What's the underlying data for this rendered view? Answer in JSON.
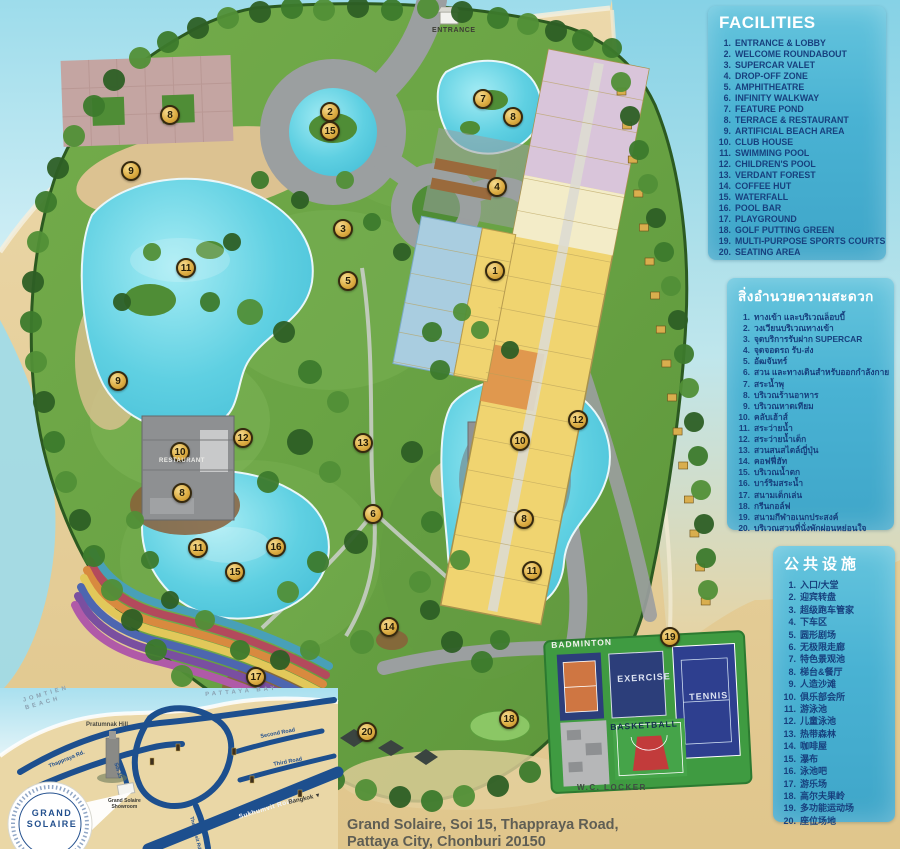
{
  "page": {
    "address_line1": "Grand Solaire, Soi 15, Thappraya Road,",
    "address_line2": "Pattaya City, Chonburi 20150"
  },
  "legend_en": {
    "title": "FACILITIES",
    "items": [
      "ENTRANCE & LOBBY",
      "WELCOME ROUNDABOUT",
      "SUPERCAR VALET",
      "DROP-OFF ZONE",
      "AMPHITHEATRE",
      "INFINITY WALKWAY",
      "FEATURE POND",
      "TERRACE & RESTAURANT",
      "ARTIFICIAL BEACH AREA",
      "CLUB HOUSE",
      "SWIMMING POOL",
      "CHILDREN'S POOL",
      "VERDANT FOREST",
      "COFFEE HUT",
      "WATERFALL",
      "POOL BAR",
      "PLAYGROUND",
      "GOLF PUTTING GREEN",
      "MULTI-PURPOSE SPORTS COURTS",
      "SEATING AREA"
    ]
  },
  "legend_th": {
    "title": "สิ่งอำนวยความสะดวก",
    "items": [
      "ทางเข้า และบริเวณล็อบบี้",
      "วงเวียนบริเวณทางเข้า",
      "จุดบริการรับฝาก SUPERCAR",
      "จุดจอดรถ รับ-ส่ง",
      "อัฒจันทร์",
      "สวน และทางเดินสำหรับออกกำลังกาย",
      "สระน้ำพุ",
      "บริเวณร้านอาหาร",
      "บริเวณหาดเทียม",
      "คลับเฮ้าส์",
      "สระว่ายน้ำ",
      "สระว่ายน้ำเด็ก",
      "สวนสนสไตล์ญี่ปุ่น",
      "คอฟฟี่ฮัท",
      "บริเวณน้ำตก",
      "บาร์ริมสระน้ำ",
      "สนามเด็กเล่น",
      "กรีนกอล์ฟ",
      "สนามกีฬาอเนกประสงค์",
      "บริเวณสวนที่นั่งพักผ่อนหย่อนใจ"
    ]
  },
  "legend_zh": {
    "title": "公共设施",
    "items": [
      "入口/大堂",
      "迎宾转盘",
      "超级跑车管家",
      "下车区",
      "圆形剧场",
      "无极限走廊",
      "特色景观池",
      "梯台&餐厅",
      "人造沙滩",
      "俱乐部会所",
      "游泳池",
      "儿童泳池",
      "热带森林",
      "咖啡屋",
      "瀑布",
      "泳池吧",
      "游乐场",
      "高尔夫果岭",
      "多功能运动场",
      "座位场地"
    ]
  },
  "map_labels": {
    "entrance": "ENTRANCE",
    "restaurant": "RESTAURANT",
    "badminton": "BADMINTON",
    "exercise": "EXERCISE",
    "tennis": "TENNIS",
    "basketball": "BASKETBALL",
    "locker": "W.C. LOCKER"
  },
  "inset": {
    "jomtien_line1": "JOMTIEN",
    "jomtien_line2": "BEACH",
    "pattaya_bay": "PATTAYA BAY",
    "pratumnak": "Pratumnak Hill",
    "thappraya": "Thappraya Rd.",
    "soi15": "Soi 15",
    "second_road": "Second Road",
    "third_road": "Third Road",
    "thepprasit": "Thepprasit Rd.",
    "sukhumvit": "Sukhumvit Road",
    "bangkok": "Bangkok ▼",
    "showroom_line1": "Grand Solaire",
    "showroom_line2": "Showroom",
    "logo_line1": "GRAND",
    "logo_line2": "SOLAIRE"
  },
  "markers": [
    {
      "n": 1,
      "x": 495,
      "y": 271
    },
    {
      "n": 2,
      "x": 330,
      "y": 112
    },
    {
      "n": 3,
      "x": 343,
      "y": 229
    },
    {
      "n": 4,
      "x": 497,
      "y": 187
    },
    {
      "n": 5,
      "x": 348,
      "y": 281
    },
    {
      "n": 6,
      "x": 373,
      "y": 514
    },
    {
      "n": 7,
      "x": 483,
      "y": 99
    },
    {
      "n": 8,
      "x": 513,
      "y": 117
    },
    {
      "n": 8,
      "x": 170,
      "y": 115
    },
    {
      "n": 8,
      "x": 182,
      "y": 493
    },
    {
      "n": 8,
      "x": 524,
      "y": 519
    },
    {
      "n": 9,
      "x": 131,
      "y": 171
    },
    {
      "n": 9,
      "x": 118,
      "y": 381
    },
    {
      "n": 10,
      "x": 180,
      "y": 452
    },
    {
      "n": 10,
      "x": 520,
      "y": 441
    },
    {
      "n": 11,
      "x": 186,
      "y": 268
    },
    {
      "n": 11,
      "x": 198,
      "y": 548
    },
    {
      "n": 11,
      "x": 532,
      "y": 571
    },
    {
      "n": 12,
      "x": 243,
      "y": 438
    },
    {
      "n": 12,
      "x": 578,
      "y": 420
    },
    {
      "n": 13,
      "x": 363,
      "y": 443
    },
    {
      "n": 14,
      "x": 389,
      "y": 627
    },
    {
      "n": 15,
      "x": 330,
      "y": 131
    },
    {
      "n": 15,
      "x": 235,
      "y": 572
    },
    {
      "n": 16,
      "x": 276,
      "y": 547
    },
    {
      "n": 17,
      "x": 256,
      "y": 677
    },
    {
      "n": 18,
      "x": 509,
      "y": 719
    },
    {
      "n": 19,
      "x": 670,
      "y": 637
    },
    {
      "n": 20,
      "x": 367,
      "y": 732
    }
  ],
  "colors": {
    "panel_bg": "#49b2d3",
    "panel_text": "#17407e",
    "marker_gold": "#dcac41",
    "sea": "#8fd6e6",
    "sand": "#e7d3a2",
    "site_green": "#69a344",
    "road": "#9b9fa0",
    "pool": "#58cbe0",
    "court_navy": "#2c3e7a",
    "court_green": "#3f9b41",
    "road_navy": "#1d4f8e"
  }
}
